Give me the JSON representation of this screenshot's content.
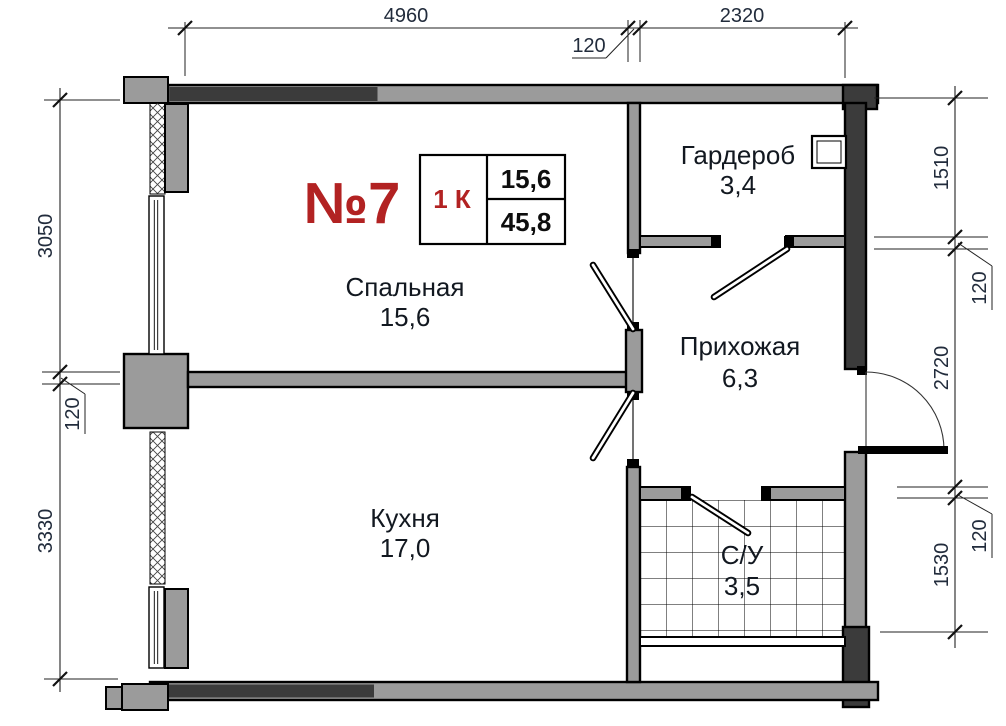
{
  "palette": {
    "wall_light": "#9b9b9b",
    "wall_dark": "#3b3b3b",
    "line": "#000000",
    "accent_red": "#b22222",
    "dim_text": "#222c3c",
    "room_text": "#121820",
    "bg": "#ffffff"
  },
  "apartment_card": {
    "number": "№7",
    "rooms_type": "1 К",
    "living_area": "15,6",
    "total_area": "45,8"
  },
  "rooms": {
    "bedroom": {
      "name": "Спальная",
      "area": "15,6"
    },
    "kitchen": {
      "name": "Кухня",
      "area": "17,0"
    },
    "wardrobe": {
      "name": "Гардероб",
      "area": "3,4"
    },
    "hallway": {
      "name": "Прихожая",
      "area": "6,3"
    },
    "bathroom": {
      "name": "С/У",
      "area": "3,5"
    }
  },
  "dimensions": {
    "top": {
      "w1": "4960",
      "wall": "120",
      "w2": "2320"
    },
    "left": {
      "h1": "3050",
      "wall": "120",
      "h2": "3330"
    },
    "right": {
      "h1": "1510",
      "wall1": "120",
      "h2": "2720",
      "wall2": "120",
      "h3": "1530"
    }
  }
}
